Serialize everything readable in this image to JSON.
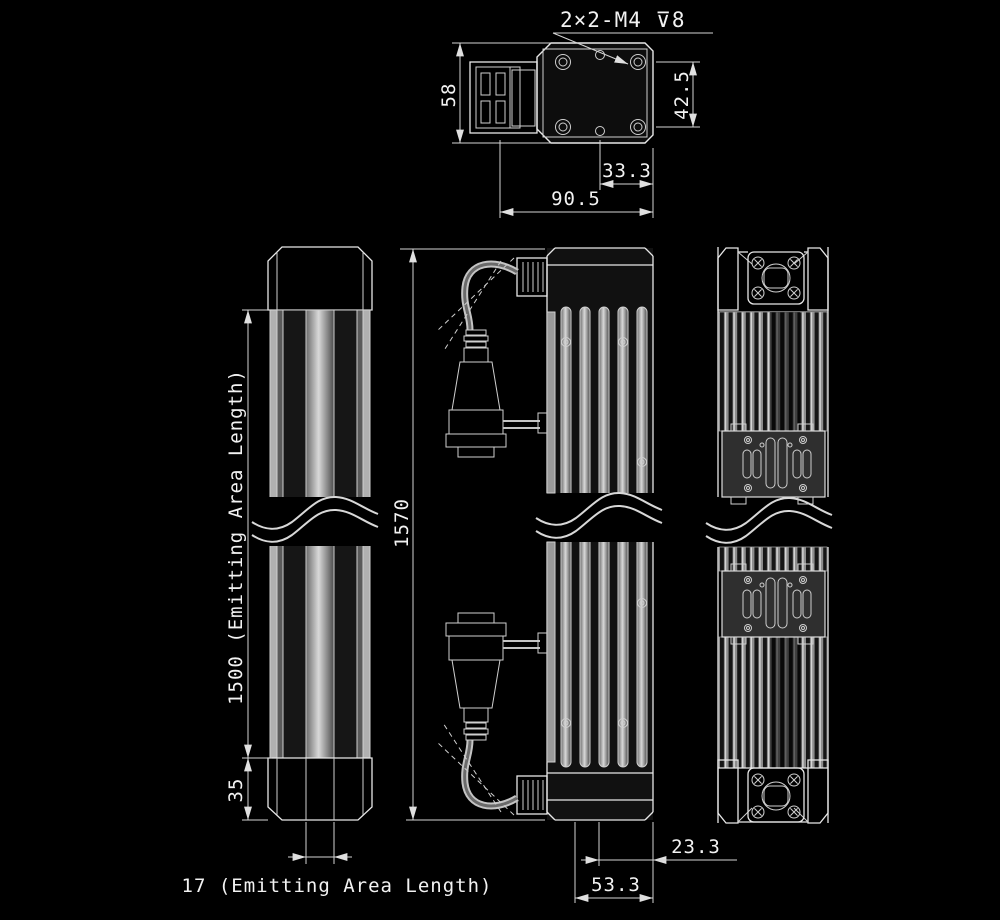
{
  "labels": {
    "thread_callout": "2×2-M4 ⊽8",
    "dim_58": "58",
    "dim_42_5": "42.5",
    "dim_33_3": "33.3",
    "dim_90_5": "90.5",
    "dim_1500": "1500 (Emitting Area Length)",
    "dim_35": "35",
    "dim_17": "17 (Emitting Area Length)",
    "dim_1570": "1570",
    "dim_23_3": "23.3",
    "dim_53_3": "53.3"
  },
  "colors": {
    "background": "#000000",
    "edge_line": "#e8e8e8",
    "dimension_line": "#d5d5d5",
    "text": "#f2f2f2",
    "metal_light": "#d9d9d9",
    "metal_dark": "#161616"
  }
}
